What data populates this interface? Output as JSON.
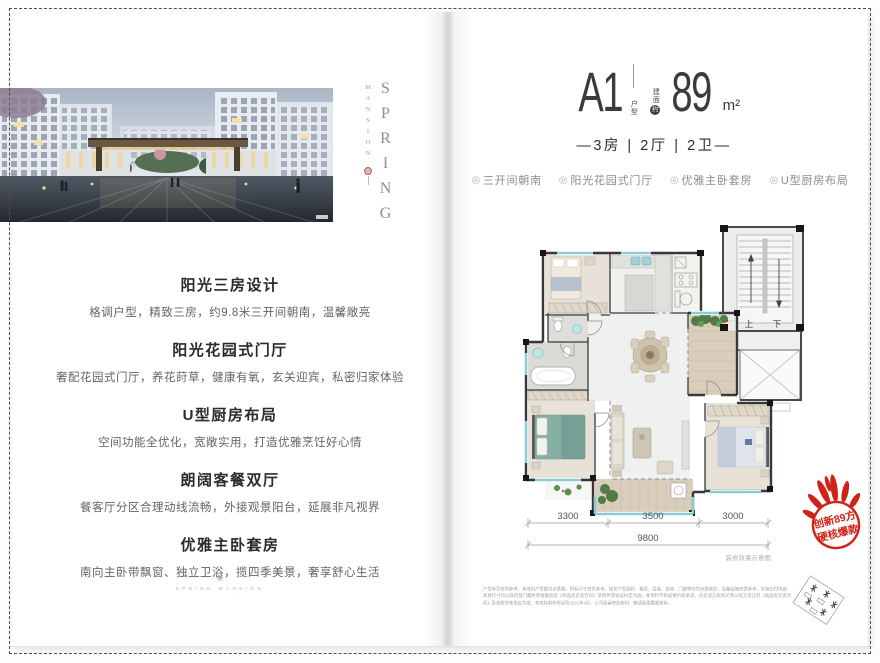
{
  "brand": {
    "vertical_name": "SPRING",
    "vertical_sub": "MANSION",
    "footer_glyph": "❋",
    "footer_line": "SPRING MANSION",
    "footer_dots": "· · · · ·"
  },
  "left_page": {
    "sections": [
      {
        "heading": "阳光三房设计",
        "body": "格调户型，精致三房，约9.8米三开间朝南，温馨敞亮"
      },
      {
        "heading": "阳光花园式门厅",
        "body": "奢配花园式门厅，养花莳草，健康有氧，玄关迎宾，私密归家体验"
      },
      {
        "heading": "U型厨房布局",
        "body": "空间功能全优化，宽敞实用，打造优雅烹饪好心情"
      },
      {
        "heading": "朗阔客餐双厅",
        "body": "餐客厅分区合理动线流畅，外接观景阳台，延展非凡视界"
      },
      {
        "heading": "优雅主卧套房",
        "body": "南向主卧带飘窗、独立卫浴，揽四季美景，奢享舒心生活"
      }
    ]
  },
  "right_page": {
    "unit": {
      "code": "A1",
      "code_label": "户型",
      "area_prefix": "建面",
      "area_circle": "约",
      "area_value": "89",
      "area_unit": "m²",
      "rooms_line": "—3房 | 2厅 | 2卫—"
    },
    "tag_icon": "◎",
    "tags": [
      "三开间朝南",
      "阳光花园式门厅",
      "优雅主卧套房",
      "U型厨房布局"
    ],
    "floorplan": {
      "stair_up": "上",
      "stair_down": "下",
      "dims": [
        "3300",
        "3500",
        "3000"
      ],
      "dim_total": "9800",
      "caption": "装修效果示意图"
    },
    "badge": {
      "line1": "创新89方",
      "line2": "硬核爆款"
    },
    "disclaimer": "户型单页仅供参考，本资料户型图为示意图，所标尺寸仅供参考，相关户型面积、格局、层高、装修、门窗等均为示意表达，设备设施仅供参考，实际交付内容、具体尺寸均以政府部门最终审批图纸及《商品房买卖合同》及附件等协议约定为准；本资料不构成要约或承诺，买卖双方权利义务以双方签订的《商品房买卖合同》及其附件等协议为准；本资料制作时间为2021年4月，公司保留修改权利，敬请留意最新资料。"
  },
  "colors": {
    "accent_red": "#cf2318",
    "window_teal": "#8ccdd4"
  }
}
